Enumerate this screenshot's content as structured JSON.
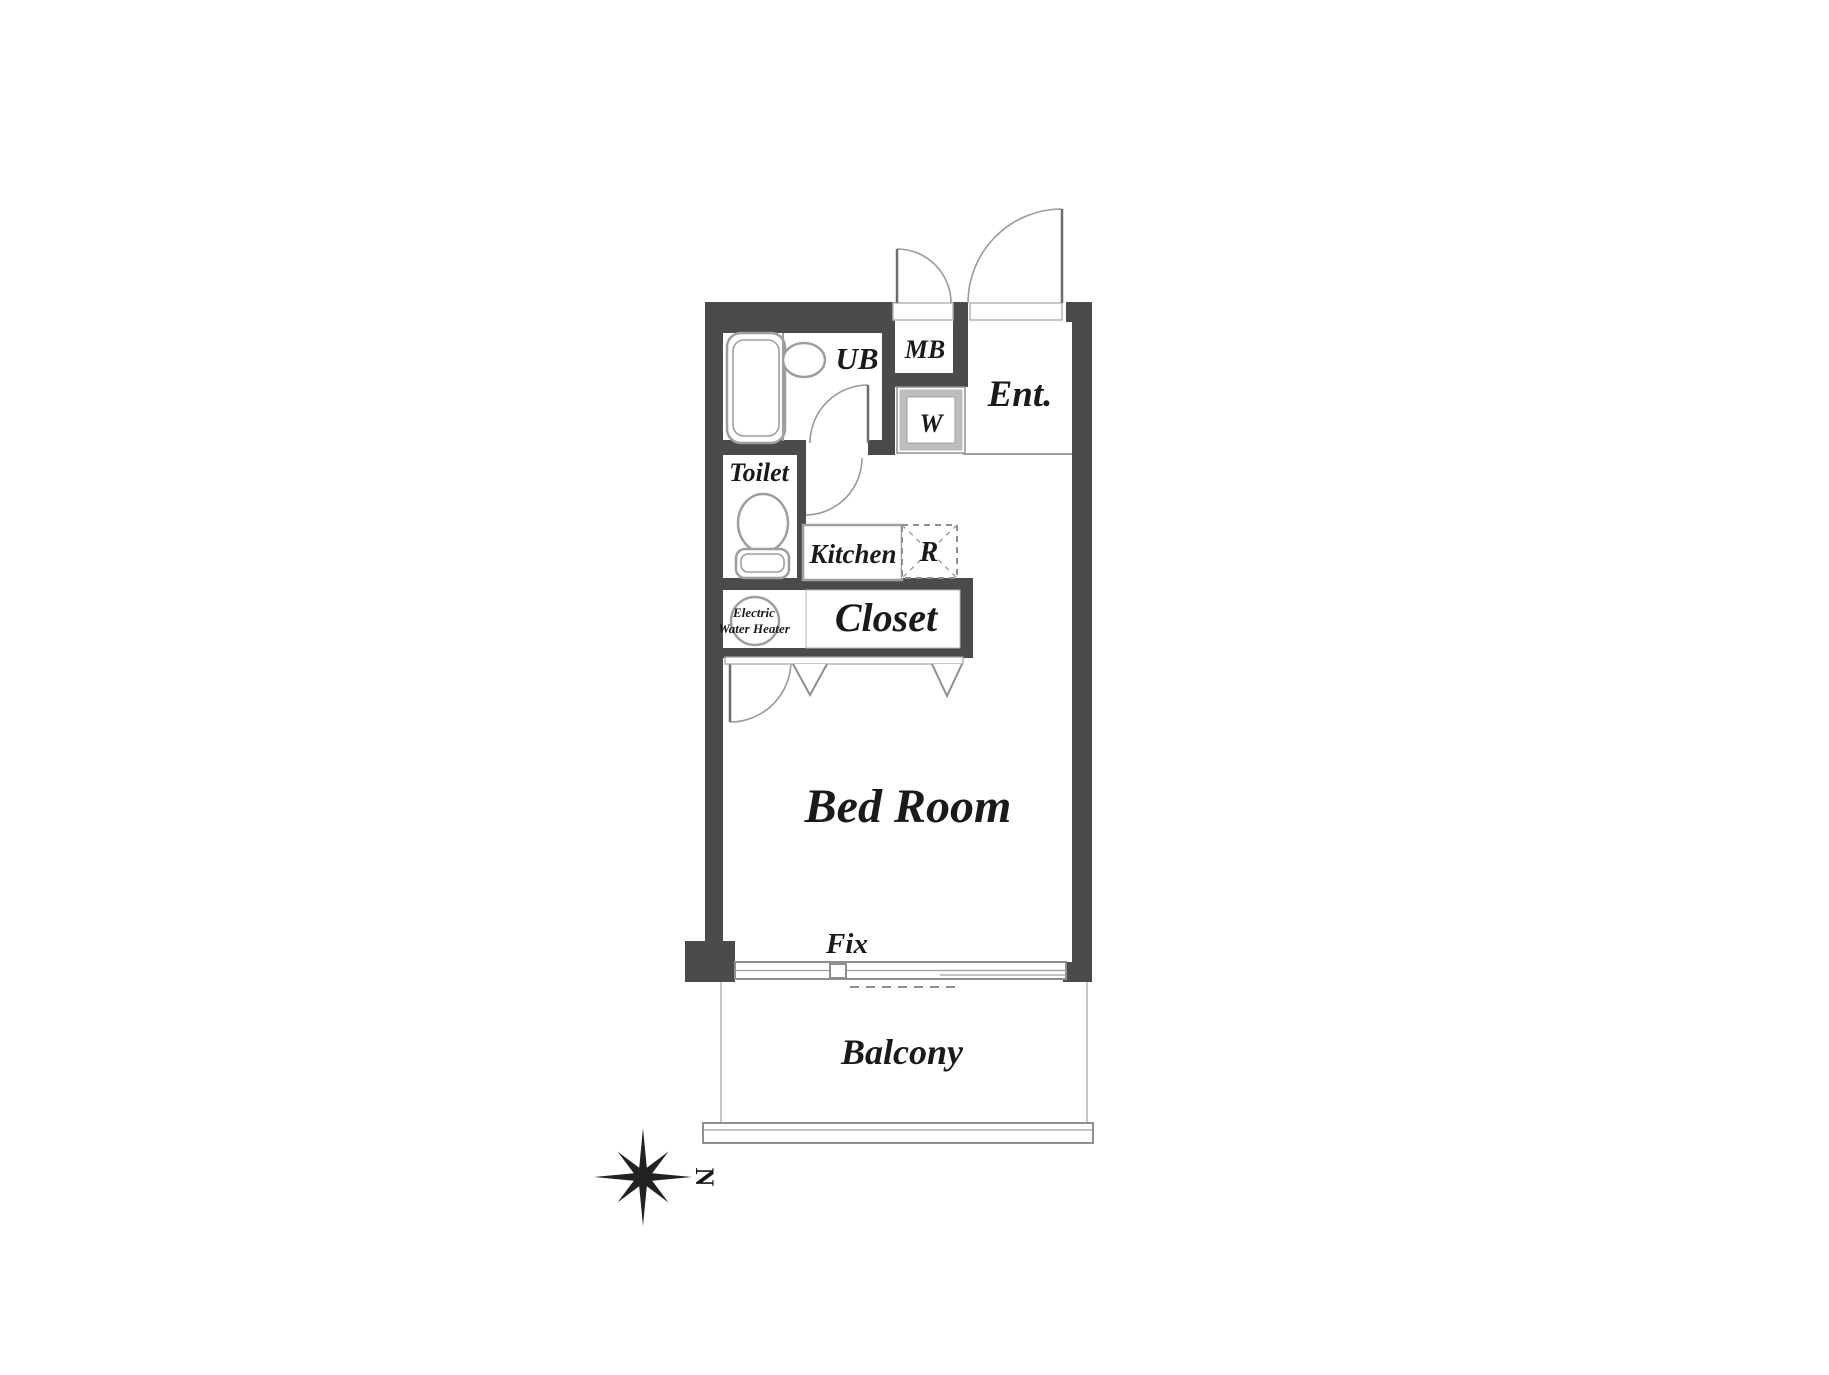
{
  "plan": {
    "rooms": {
      "ub": "UB",
      "mb": "MB",
      "entrance": "Ent.",
      "washer": "W",
      "toilet": "Toilet",
      "kitchen": "Kitchen",
      "refrigerator": "R",
      "closet": "Closet",
      "bedroom": "Bed Room",
      "balcony": "Balcony"
    },
    "labels": {
      "fix_window": "Fix",
      "water_heater_line1": "Electric",
      "water_heater_line2": "Water Heater"
    },
    "compass": {
      "north": "N"
    },
    "colors": {
      "wall": "#4b4b4b",
      "line": "#9e9e9e",
      "text": "#1a1a1a",
      "background": "#ffffff"
    }
  }
}
